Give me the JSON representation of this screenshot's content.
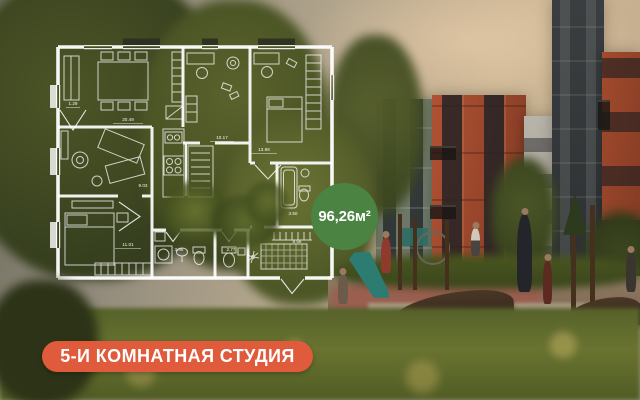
{
  "badge": {
    "area_label": "96,26м²",
    "color": "#4a8342"
  },
  "banner": {
    "label": "5-И КОМНАТНАЯ СТУДИЯ",
    "color": "#df5b3b"
  },
  "floorplan": {
    "line_color": "#ffffff",
    "rooms": [
      {
        "name": "dining-living",
        "area": "20.49"
      },
      {
        "name": "bay-niche",
        "area": "1.29"
      },
      {
        "name": "study-room",
        "area": "10.17"
      },
      {
        "name": "bedroom-right",
        "area": "13.98"
      },
      {
        "name": "lounge",
        "area": "9.03"
      },
      {
        "name": "bedroom-left",
        "area": "11.01"
      },
      {
        "name": "bathroom",
        "area": "3.86"
      },
      {
        "name": "wc",
        "area": "2.77"
      },
      {
        "name": "hallway",
        "area": "8.56"
      },
      {
        "name": "bathroom-right",
        "area": "3.50"
      }
    ]
  },
  "scene": {
    "description_colors": {
      "sky_warm": "#cdb795",
      "building_red_brick": "#a84c2e",
      "building_gray": "#75806f",
      "building_light": "#b4b0a6",
      "building_dark_brick": "#34383a",
      "trees": "#45511f",
      "grass": "#5c672b",
      "slide_teal": "#2c7c72",
      "pavement": "#8f7b64"
    }
  }
}
